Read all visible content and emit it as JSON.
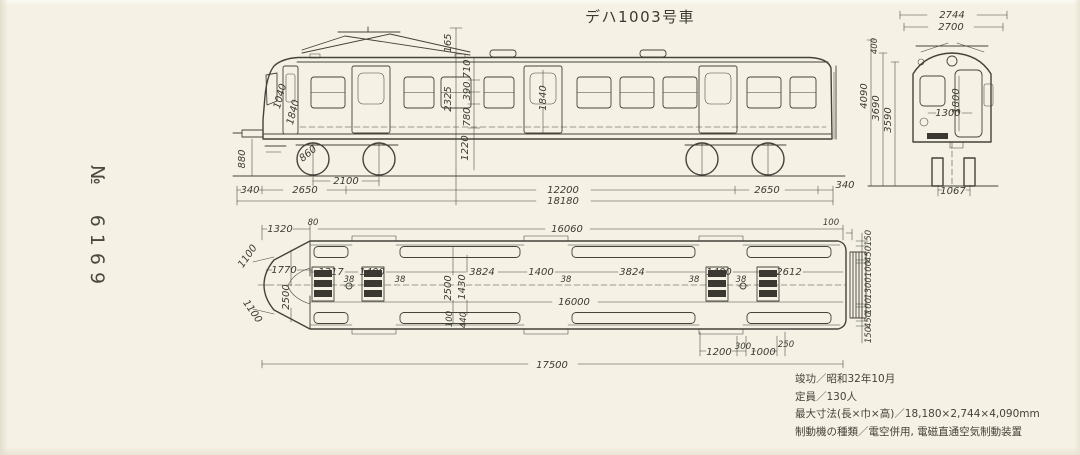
{
  "page": {
    "title": "デハ1003号車",
    "serial_prefix": "№",
    "serial_number": "6169"
  },
  "specs": [
    {
      "label": "竣功",
      "sep": "／",
      "value": "昭和32年10月"
    },
    {
      "label": "定員",
      "sep": "／",
      "value": "130人"
    },
    {
      "label": "最大寸法(長×巾×高)",
      "sep": "／",
      "value": "18,180×2,744×4,090mm"
    },
    {
      "label": "制動機の種類",
      "sep": "／",
      "value": "電空併用, 電磁直通空気制動装置"
    }
  ],
  "colors": {
    "paper": "#f5f1e4",
    "ink": "#45423a"
  },
  "side_view": {
    "description": "車体側面図",
    "labels": [
      {
        "t": "2100",
        "x": 346,
        "y": 184
      },
      {
        "t": "340",
        "x": 250,
        "y": 193
      },
      {
        "t": "2650",
        "x": 305,
        "y": 193
      },
      {
        "t": "12200",
        "x": 563,
        "y": 193
      },
      {
        "t": "2650",
        "x": 767,
        "y": 193
      },
      {
        "t": "340",
        "x": 845,
        "y": 188
      },
      {
        "t": "18180",
        "x": 563,
        "y": 204
      },
      {
        "t": "880",
        "x": 245,
        "y": 159,
        "r": -90
      },
      {
        "t": "165",
        "x": 451,
        "y": 43,
        "r": -90
      },
      {
        "t": "2325",
        "x": 451,
        "y": 99,
        "r": -90
      },
      {
        "t": "710",
        "x": 470,
        "y": 69,
        "r": -90
      },
      {
        "t": "390",
        "x": 470,
        "y": 91,
        "r": -90
      },
      {
        "t": "780",
        "x": 470,
        "y": 117,
        "r": -90
      },
      {
        "t": "1220",
        "x": 468,
        "y": 148,
        "r": -90
      },
      {
        "t": "1840",
        "x": 546,
        "y": 98,
        "r": -90
      },
      {
        "t": "1040",
        "x": 283,
        "y": 97,
        "r": -75
      },
      {
        "t": "1840",
        "x": 296,
        "y": 113,
        "r": -75
      },
      {
        "t": "860",
        "x": 310,
        "y": 156,
        "r": -40
      }
    ]
  },
  "end_view": {
    "description": "妻面図",
    "labels": [
      {
        "t": "2744",
        "x": 952,
        "y": 18
      },
      {
        "t": "2700",
        "x": 951,
        "y": 30
      },
      {
        "t": "400",
        "x": 877,
        "y": 46,
        "r": -90,
        "s": 1
      },
      {
        "t": "4090",
        "x": 867,
        "y": 96,
        "r": -90
      },
      {
        "t": "3690",
        "x": 879,
        "y": 108,
        "r": -90
      },
      {
        "t": "3590",
        "x": 891,
        "y": 120,
        "r": -90
      },
      {
        "t": "1800",
        "x": 959,
        "y": 101,
        "r": -90
      },
      {
        "t": "1300",
        "x": 948,
        "y": 116
      },
      {
        "t": "1067",
        "x": 953,
        "y": 194
      }
    ]
  },
  "plan_view": {
    "description": "平面図",
    "labels": [
      {
        "t": "1320",
        "x": 280,
        "y": 232
      },
      {
        "t": "80",
        "x": 313,
        "y": 225,
        "s": 1
      },
      {
        "t": "16060",
        "x": 567,
        "y": 232
      },
      {
        "t": "100",
        "x": 831,
        "y": 225,
        "s": 1
      },
      {
        "t": "1100",
        "x": 250,
        "y": 258,
        "r": -55
      },
      {
        "t": "1100",
        "x": 250,
        "y": 313,
        "r": 55
      },
      {
        "t": "1770",
        "x": 284,
        "y": 273
      },
      {
        "t": "2500",
        "x": 289,
        "y": 297,
        "r": -90
      },
      {
        "t": "1317",
        "x": 331,
        "y": 275
      },
      {
        "t": "38",
        "x": 349,
        "y": 282,
        "s": 1
      },
      {
        "t": "1400",
        "x": 372,
        "y": 275
      },
      {
        "t": "38",
        "x": 400,
        "y": 282,
        "s": 1
      },
      {
        "t": "3824",
        "x": 482,
        "y": 275
      },
      {
        "t": "1400",
        "x": 541,
        "y": 275
      },
      {
        "t": "38",
        "x": 566,
        "y": 282,
        "s": 1
      },
      {
        "t": "3824",
        "x": 632,
        "y": 275
      },
      {
        "t": "38",
        "x": 694,
        "y": 282,
        "s": 1
      },
      {
        "t": "1400",
        "x": 719,
        "y": 275
      },
      {
        "t": "38",
        "x": 741,
        "y": 282,
        "s": 1
      },
      {
        "t": "2612",
        "x": 789,
        "y": 275
      },
      {
        "t": "2500",
        "x": 451,
        "y": 288,
        "r": -90
      },
      {
        "t": "1430",
        "x": 465,
        "y": 287,
        "r": -90
      },
      {
        "t": "100",
        "x": 452,
        "y": 319,
        "r": -90,
        "s": 1
      },
      {
        "t": "440",
        "x": 466,
        "y": 320,
        "r": -90,
        "s": 1
      },
      {
        "t": "16000",
        "x": 574,
        "y": 305
      },
      {
        "t": "1200",
        "x": 719,
        "y": 355
      },
      {
        "t": "300",
        "x": 743,
        "y": 349,
        "s": 1
      },
      {
        "t": "1000",
        "x": 763,
        "y": 355
      },
      {
        "t": "250",
        "x": 786,
        "y": 347,
        "s": 1
      },
      {
        "t": "17500",
        "x": 552,
        "y": 368
      },
      {
        "t": "150",
        "x": 871,
        "y": 238,
        "r": -90,
        "s": 1
      },
      {
        "t": "450",
        "x": 871,
        "y": 254,
        "r": -90,
        "s": 1
      },
      {
        "t": "100",
        "x": 871,
        "y": 269,
        "r": -90,
        "s": 1
      },
      {
        "t": "1300",
        "x": 871,
        "y": 288,
        "r": -90,
        "s": 1
      },
      {
        "t": "100",
        "x": 871,
        "y": 306,
        "r": -90,
        "s": 1
      },
      {
        "t": "450",
        "x": 871,
        "y": 320,
        "r": -90,
        "s": 1
      },
      {
        "t": "150",
        "x": 871,
        "y": 335,
        "r": -90,
        "s": 1
      }
    ]
  }
}
